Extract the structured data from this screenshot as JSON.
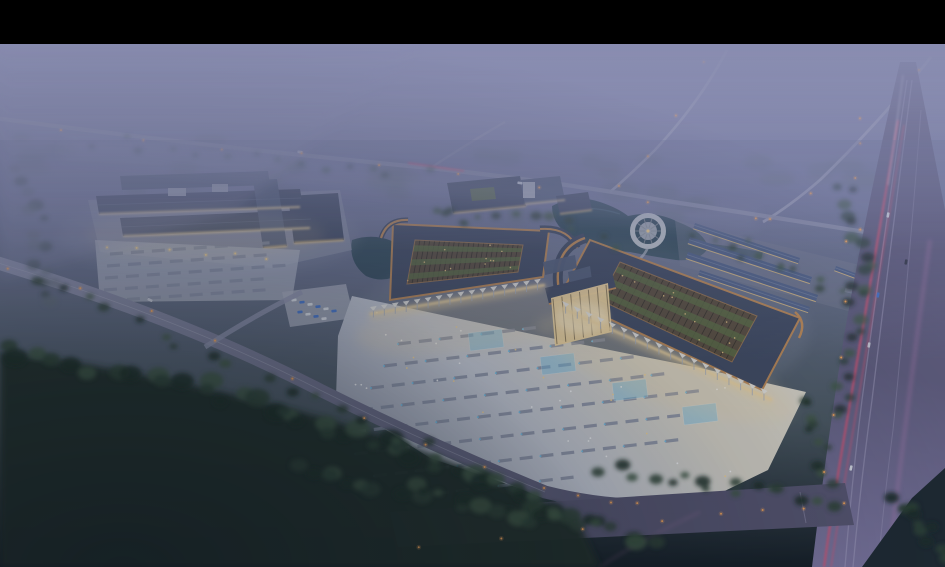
{
  "scene": {
    "kind": "architectural-aerial-rendering",
    "time_of_day": "dusk",
    "elements": [
      "letterbox-bar",
      "haze-sky",
      "distant-roads",
      "service-road",
      "left-market-complex",
      "left-parking-lot",
      "admin-building",
      "pond",
      "circular-plaza",
      "left-pavilion",
      "right-pavilion",
      "entrance-gate",
      "front-plaza",
      "parking-rows",
      "fountain-pools",
      "row-warehouses",
      "highway",
      "light-trails",
      "front-road",
      "forest",
      "fog-overlay"
    ]
  },
  "palette": {
    "letterbox": "#000000",
    "haze_top": "#8c8fb2",
    "haze_mid": "#757a9e",
    "haze_low": "#5b6579",
    "distant_tree": "#5c6a70",
    "mid_ground": "#49565e",
    "ground_dark": "#1a252c",
    "field_dark": "#10191f",
    "tree_dark": "#1b2a22",
    "tree_mid": "#2a3e30",
    "tree_light": "#3d5640",
    "road_distant": "#a2a5bc",
    "road_light": "#8e92ac",
    "road_purple": "#55536e",
    "highway_top": "#5d5a7a",
    "highway_bottom": "#7d76a0",
    "lane_line": "#b3aecd",
    "trail_red": "#e8506e",
    "trail_pink": "#d887c4",
    "lamp_orange": "#ffaa55",
    "lamp_bright": "#ffd98f",
    "plaza_light": "#ccd0da",
    "plaza_warm": "#ddd8ca",
    "plaza_shadow": "#9aa0b2",
    "park_strip": "#868da2",
    "marker_blue": "#74c6ee",
    "roof_dark": "#3f4960",
    "roof_mid": "#515d77",
    "roof_ridge": "#68748f",
    "roof_blue": "#4f6086",
    "trim_copper": "#c18a52",
    "court_brown": "#584b3b",
    "court_line": "#2e2a22",
    "court_green": "#5b6b41",
    "glow_warm": "#f6d99f",
    "window_warm": "#e9c47f",
    "wall_light": "#b5bac4",
    "colonnade_white": "#e9e7e0",
    "column_gray": "#a7b0c1",
    "pond": "#2e4856",
    "pond_light": "#4c6a7c",
    "circle_plaza": "#d3d6da",
    "car_blue": "#3f72cc",
    "car_white": "#dde1e8"
  }
}
